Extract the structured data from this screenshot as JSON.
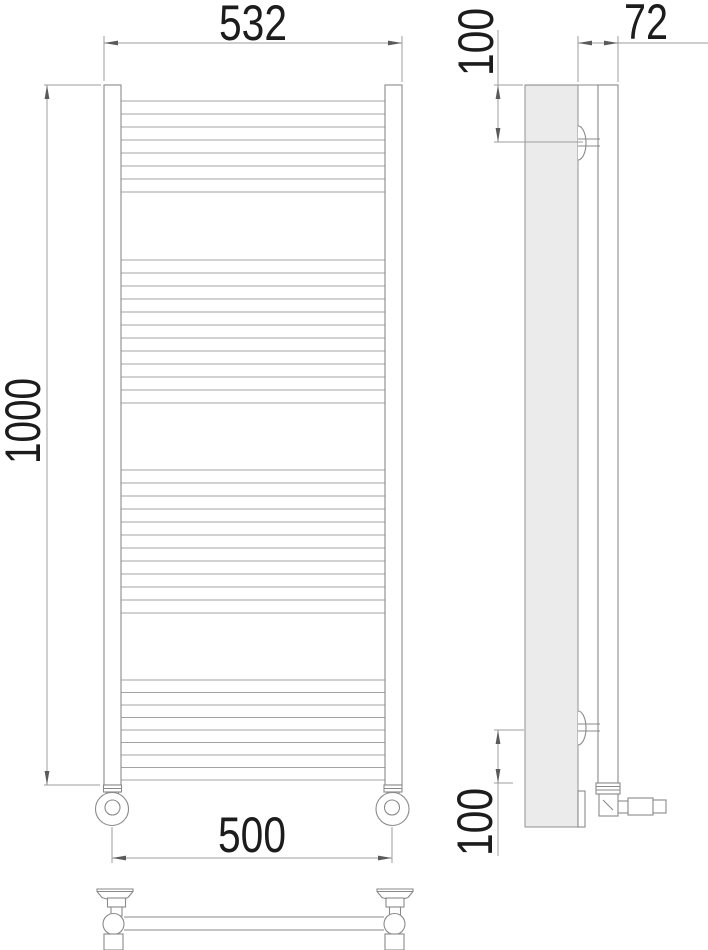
{
  "drawing": {
    "type": "technical-dimension-drawing",
    "subject": "ladder towel radiator, front / side / bottom views",
    "colors": {
      "background": "#ffffff",
      "outline": "#8a8a8a",
      "panel_fill": "#ebebeb",
      "dimension_line": "#9d9d9d",
      "text": "#1c1c1c"
    }
  },
  "dimensions": {
    "overall_width": "532",
    "overall_height": "1000",
    "connection_spacing": "500",
    "depth": "72",
    "top_bracket_offset": "100",
    "bottom_bracket_offset": "100"
  },
  "front_view": {
    "rung_x1": 121,
    "rung_x2": 385,
    "rung_groups": [
      {
        "y_start": 101,
        "spacing": 13,
        "count": 8
      },
      {
        "y_start": 260,
        "spacing": 13,
        "count": 12
      },
      {
        "y_start": 470,
        "spacing": 13,
        "count": 12
      },
      {
        "y_start": 680,
        "spacing": 12.5,
        "count": 9
      }
    ]
  }
}
